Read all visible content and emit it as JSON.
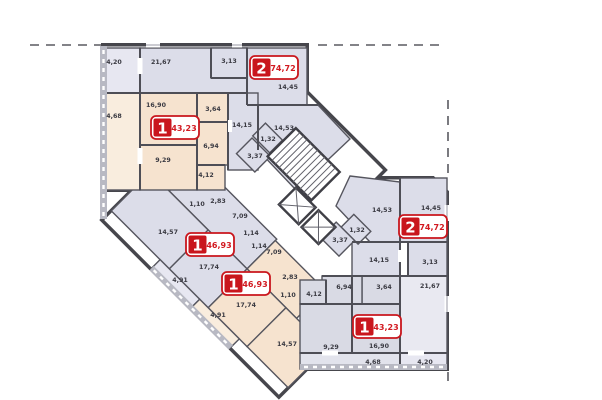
{
  "plan": {
    "colors": {
      "wall": "#4e4e56",
      "apartment_1_fill": "#f6e3cf",
      "apartment_2_fill": "#dcdde9",
      "apartment_1_south_fill": "#d9dae4",
      "balcony_peach": "#f9edde",
      "balcony_lavender": "#e7e7f1",
      "parapet_gray": "#b8b9c3",
      "badge_red": "#c9161d"
    }
  },
  "apartments": [
    {
      "id": "apartment-2-north",
      "number": "2",
      "total_area": "74,72",
      "rooms": [
        {
          "area": "21,67"
        },
        {
          "area": "4,20"
        },
        {
          "area": "3,13"
        },
        {
          "area": "14,45"
        },
        {
          "area": "14,15"
        },
        {
          "area": "14,53"
        },
        {
          "area": "1,32"
        },
        {
          "area": "3,37"
        }
      ]
    },
    {
      "id": "apartment-1-north",
      "number": "1",
      "total_area": "43,23",
      "rooms": [
        {
          "area": "16,90"
        },
        {
          "area": "4,68"
        },
        {
          "area": "3,64"
        },
        {
          "area": "9,29"
        },
        {
          "area": "6,94"
        },
        {
          "area": "4,12"
        }
      ]
    },
    {
      "id": "apartment-1-mid-west",
      "number": "1",
      "total_area": "46,93",
      "rooms": [
        {
          "area": "14,57"
        },
        {
          "area": "17,74"
        },
        {
          "area": "7,09"
        },
        {
          "area": "1,14"
        },
        {
          "area": "2,83"
        },
        {
          "area": "1,10"
        },
        {
          "area": "4,91"
        }
      ]
    },
    {
      "id": "apartment-1-mid-east",
      "number": "1",
      "total_area": "46,93",
      "rooms": [
        {
          "area": "17,74"
        },
        {
          "area": "14,57"
        },
        {
          "area": "7,09"
        },
        {
          "area": "1,14"
        },
        {
          "area": "2,83"
        },
        {
          "area": "1,10"
        },
        {
          "area": "4,91"
        }
      ]
    },
    {
      "id": "apartment-2-south",
      "number": "2",
      "total_area": "74,72",
      "rooms": [
        {
          "area": "14,45"
        },
        {
          "area": "14,53"
        },
        {
          "area": "14,15"
        },
        {
          "area": "3,13"
        },
        {
          "area": "21,67"
        },
        {
          "area": "4,20"
        },
        {
          "area": "1,32"
        },
        {
          "area": "3,37"
        }
      ]
    },
    {
      "id": "apartment-1-south",
      "number": "1",
      "total_area": "43,23",
      "rooms": [
        {
          "area": "16,90"
        },
        {
          "area": "9,29"
        },
        {
          "area": "6,94"
        },
        {
          "area": "4,12"
        },
        {
          "area": "3,64"
        },
        {
          "area": "4,68"
        }
      ]
    }
  ]
}
